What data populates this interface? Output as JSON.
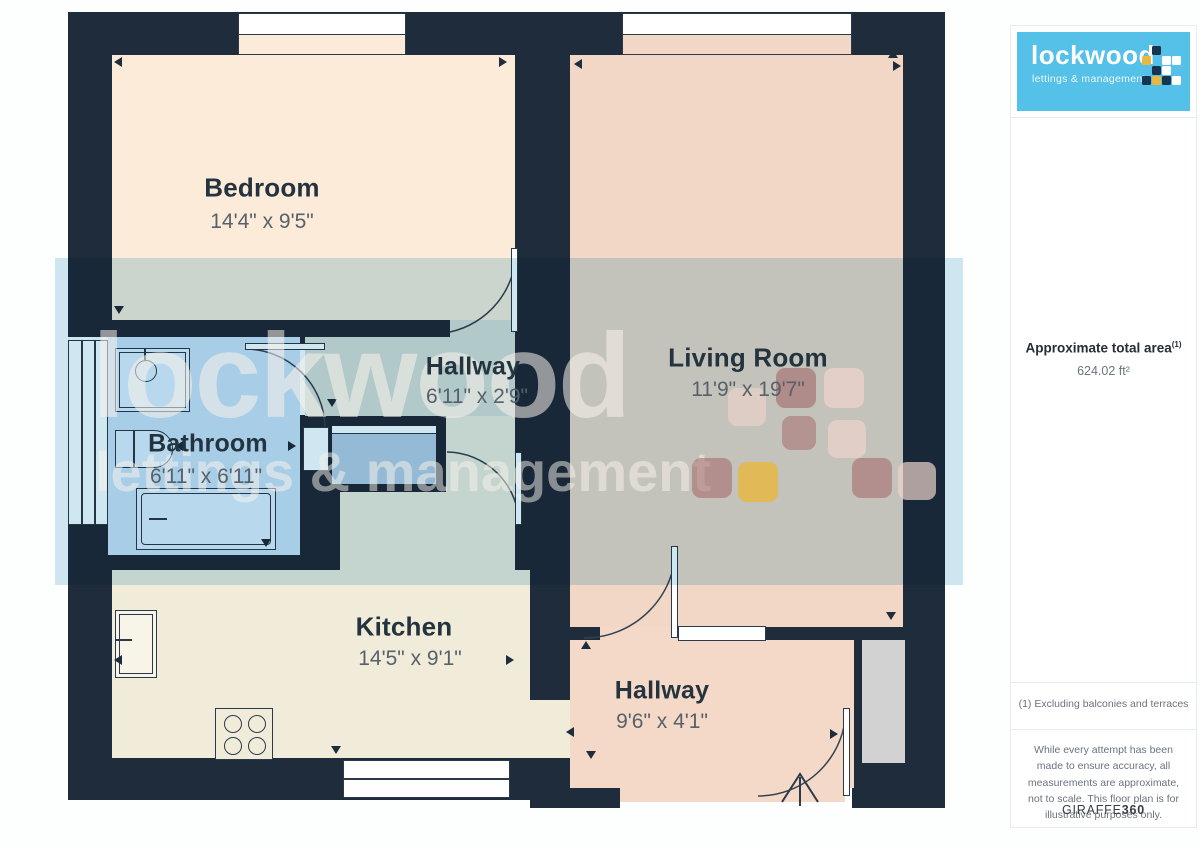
{
  "sidebar": {
    "logo": {
      "name": "lockwood",
      "tagline": "lettings & management"
    },
    "area": {
      "label": "Approximate total area",
      "superscript": "(1)",
      "value": "624.02 ft²"
    },
    "footnote": "(1) Excluding balconies and terraces",
    "disclaimer": "While every attempt has been made to ensure accuracy, all measurements are approximate, not to scale. This floor plan is for illustrative purposes only.",
    "credit": {
      "brand": "GIRAFFE",
      "suffix": "360"
    }
  },
  "floorplan": {
    "rooms": [
      {
        "id": "bedroom",
        "name": "Bedroom",
        "dimensions": "14'4\" x 9'5\""
      },
      {
        "id": "living-room",
        "name": "Living Room",
        "dimensions": "11'9\" x 19'7\""
      },
      {
        "id": "hallway",
        "name": "Hallway",
        "dimensions": "6'11\" x 2'9\""
      },
      {
        "id": "bathroom",
        "name": "Bathroom",
        "dimensions": "6'11\" x 6'11\""
      },
      {
        "id": "kitchen",
        "name": "Kitchen",
        "dimensions": "14'5\" x 9'1\""
      },
      {
        "id": "hallway-entrance",
        "name": "Hallway",
        "dimensions": "9'6\" x 4'1\""
      }
    ],
    "watermark": {
      "line1": "lockwood",
      "line2": "lettings & management"
    }
  },
  "colors": {
    "wall": "#1e2c3c",
    "bedroom_floor": "#fcebd9",
    "living_floor": "#f2d7c6",
    "bathroom_floor": "#cfe3f4",
    "kitchen_floor": "#f1ecda",
    "hallway_floor": "#dcded6",
    "entrance_hall_floor": "#f5d9c8",
    "logo_blue": "#55c0e8",
    "accent_yellow": "#eab73f",
    "accent_maroon": "#9f5c60",
    "watermark_tint": "#cfe7f1"
  }
}
